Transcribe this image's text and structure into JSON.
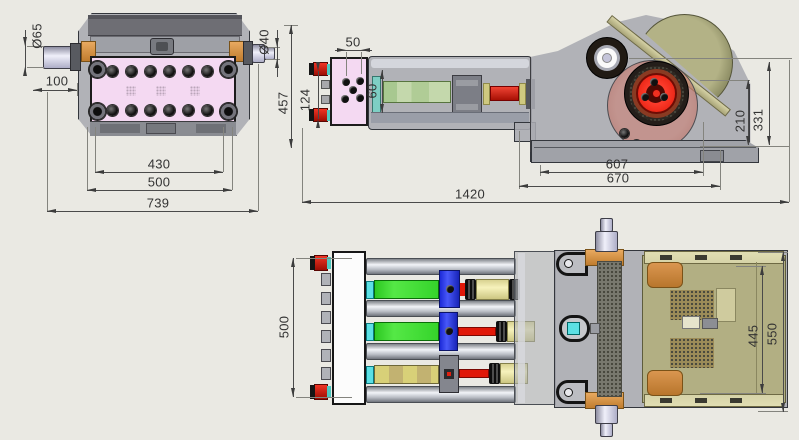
{
  "dims": {
    "top": {
      "dia_left": "Ø65",
      "offset": "100",
      "dia_right": "Ø40",
      "inner": "430",
      "mid": "500",
      "overall": "739"
    },
    "side": {
      "port": "50",
      "height": "457",
      "ports_span": "124",
      "spacing": "60",
      "len_inner": "607",
      "len_outer": "670",
      "h_crank": "210",
      "h_pinion": "331",
      "overall": "1420"
    },
    "bottom": {
      "width": "500",
      "guard": "445",
      "overall": "550"
    }
  },
  "colors": {
    "background": "#eae9e3",
    "fluid_end_pink": "#f4d9f2",
    "plunger_green": "#35d42b",
    "crosshead_blue": "#2838ea",
    "rod_red": "#e01808",
    "cyan_seal": "#5ce0e4",
    "cylinder_yellow": "#eeeaa6",
    "belt_guard_olive": "#a2a276",
    "panel_khaki": "#d6d3a8",
    "bracket_orange": "#de9b4e",
    "shaft_lavender": "#d8d8ec",
    "housing_gray": "#aaaab0",
    "dim_line": "#4a4a4a"
  }
}
